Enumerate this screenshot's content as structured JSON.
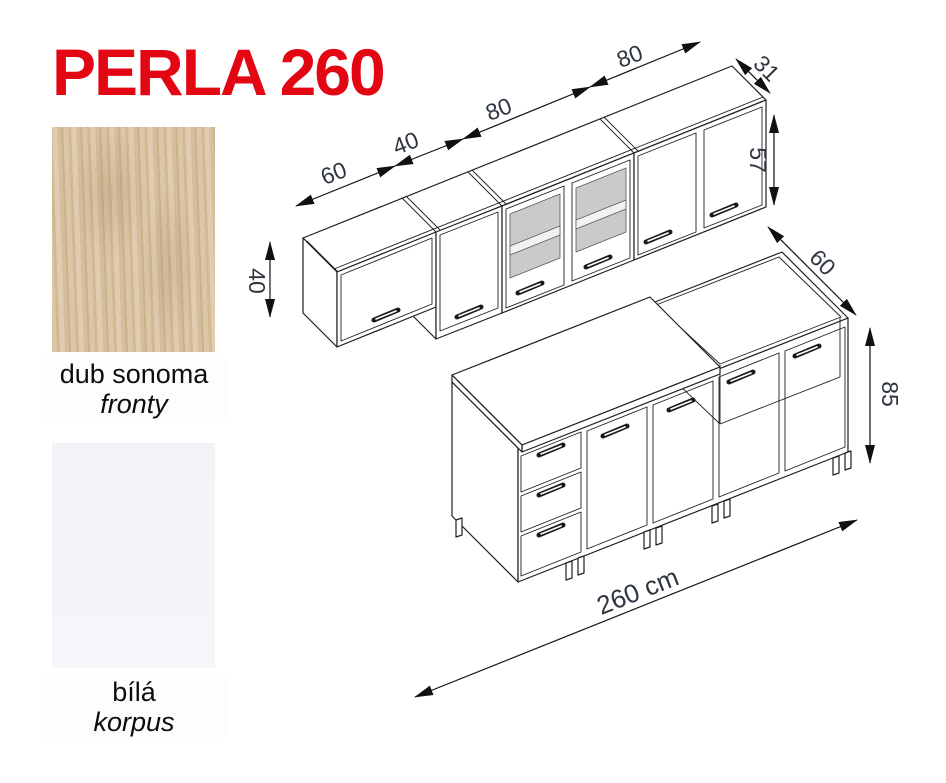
{
  "title": "PERLA 260",
  "materials": {
    "fronts": {
      "name": "dub sonoma",
      "role": "fronty"
    },
    "body": {
      "name": "bílá",
      "role": "korpus"
    }
  },
  "dimensions": {
    "upper_width_1": "60",
    "upper_width_2": "40",
    "upper_width_3": "80",
    "upper_width_4": "80",
    "upper_depth": "31",
    "upper_height_tall": "57",
    "upper_height_short": "40",
    "base_depth": "60",
    "base_height": "85",
    "total_width": "260 cm"
  },
  "colors": {
    "accent_red": "#e30613",
    "glass_gray": "#c9cacc",
    "line": "#1f1f1f",
    "dim_text": "#2e3540"
  }
}
